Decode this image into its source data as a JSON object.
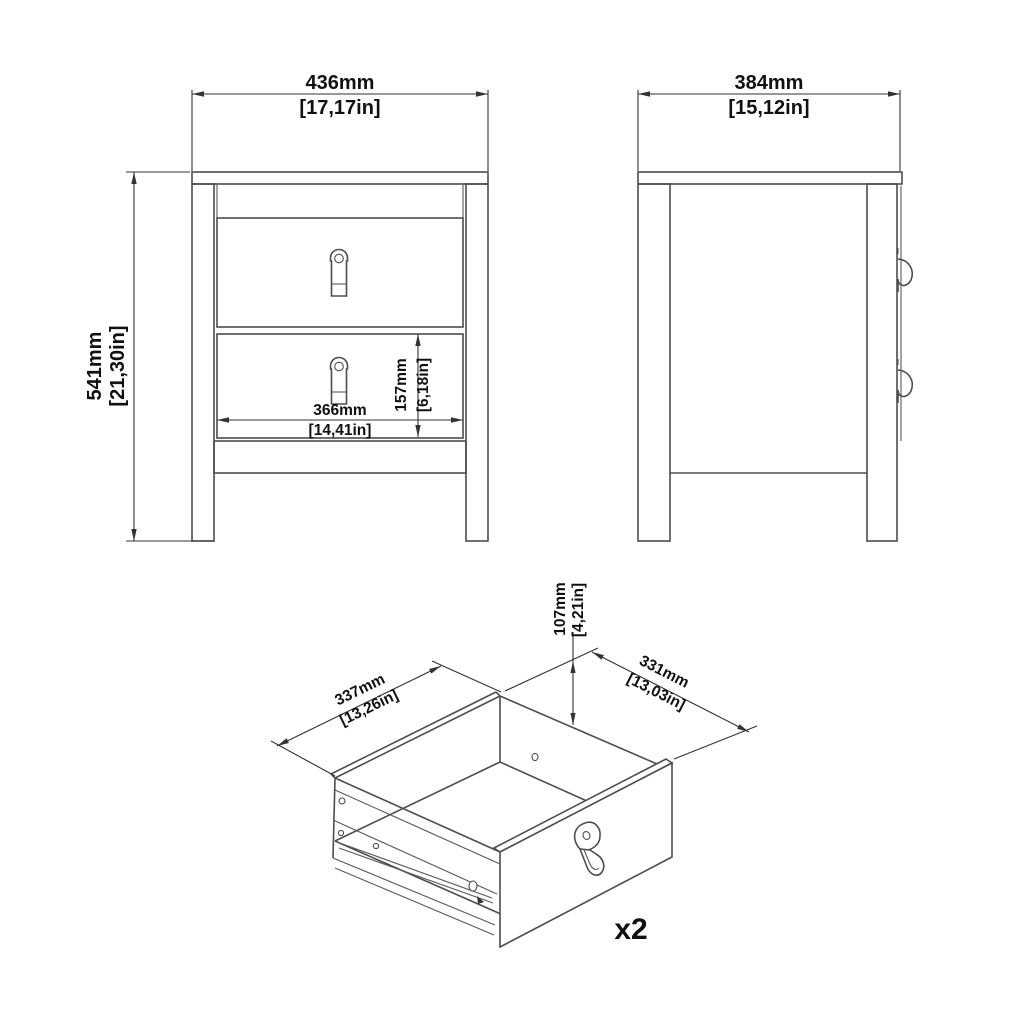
{
  "style": {
    "background": "#ffffff",
    "object_line_color": "#4d4d4d",
    "dimension_line_color": "#333333",
    "text_color": "#111111"
  },
  "front_view": {
    "width_mm": "436mm",
    "width_in": "[17,17in]",
    "height_mm": "541mm",
    "height_in": "[21,30in]",
    "drawer_width_mm": "366mm",
    "drawer_width_in": "[14,41in]",
    "drawer_front_height_mm": "157mm",
    "drawer_front_height_in": "[6,18in]"
  },
  "side_view": {
    "depth_mm": "384mm",
    "depth_in": "[15,12in]"
  },
  "drawer_view": {
    "width_mm": "337mm",
    "width_in": "[13,26in]",
    "depth_mm": "331mm",
    "depth_in": "[13,03in]",
    "height_mm": "107mm",
    "height_in": "[4,21in]",
    "quantity": "x2"
  }
}
